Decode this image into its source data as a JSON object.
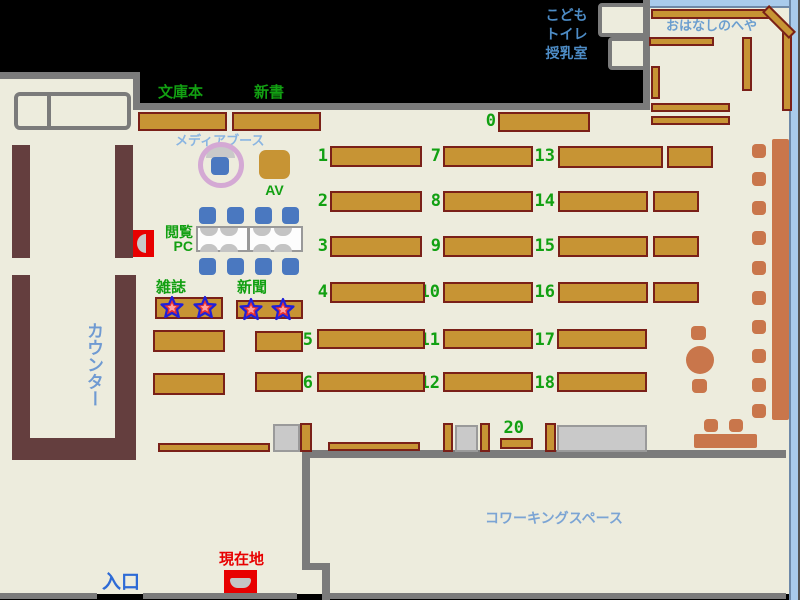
{
  "labels": {
    "paperbacks": "文庫本",
    "new_books": "新書",
    "media_booth": "メディアブース",
    "av": "AV",
    "reading_pc_line1": "閲覧",
    "reading_pc_line2": "PC",
    "magazines": "雑誌",
    "newspapers": "新聞",
    "counter": "カウンター",
    "entrance": "入口",
    "current_location": "現在地",
    "kids_line1": "こども",
    "kids_line2": "トイレ",
    "kids_line3": "授乳室",
    "story_room": "おはなしのへや",
    "coworking_space": "コワーキングスペース"
  },
  "shelf_numbers": [
    "0",
    "1",
    "2",
    "3",
    "4",
    "5",
    "6",
    "7",
    "8",
    "9",
    "10",
    "11",
    "12",
    "13",
    "14",
    "15",
    "16",
    "17",
    "18",
    "20"
  ],
  "colors": {
    "floor": "#edecdd",
    "wall_gray": "#7b7b7b",
    "shelf_gold": "#c79434",
    "shelf_border_maroon": "#7a2018",
    "counter_brown": "#643e3e",
    "furniture_terracotta": "#c9764b",
    "label_green": "#12a012",
    "label_blue": "#6f9ad2",
    "entrance_blue": "#2e6bd6",
    "marker_red": "#e80000",
    "window_light_blue": "#a9cbec",
    "star_outline_blue": "#2020d8",
    "star_fill_red": "#e83030",
    "pc_chair_blue": "#4a78c0",
    "media_ring_pink": "#d4a9d4"
  }
}
